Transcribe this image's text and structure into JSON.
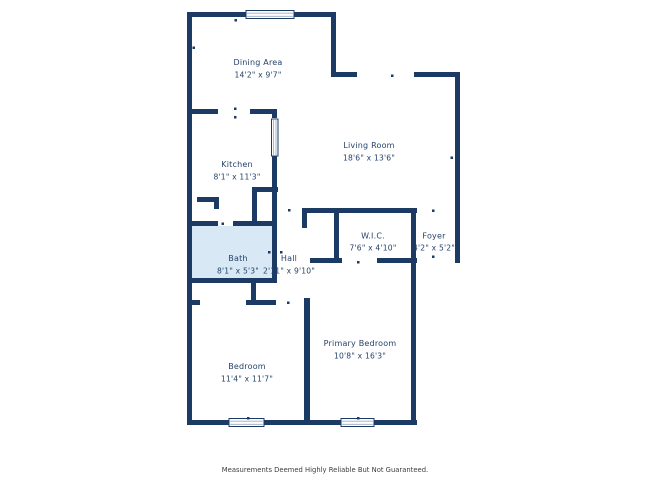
{
  "colors": {
    "wall": "#1b3a64",
    "room_label": "#24426b",
    "bath_fill": "#d9e8f5",
    "window_fill": "#ffffff",
    "window_mullion": "#9aabc2",
    "disclaimer_text": "#3d3d3d",
    "background": "#ffffff"
  },
  "rooms": [
    {
      "id": "dining-area",
      "name": "Dining Area",
      "dims": "14'2\" x 9'7\""
    },
    {
      "id": "living-room",
      "name": "Living Room",
      "dims": "18'6\" x 13'6\""
    },
    {
      "id": "kitchen",
      "name": "Kitchen",
      "dims": "8'1\" x 11'3\""
    },
    {
      "id": "bath",
      "name": "Bath",
      "dims": "8'1\" x 5'3\""
    },
    {
      "id": "hall",
      "name": "Hall",
      "dims": "2'11\" x 9'10\""
    },
    {
      "id": "wic",
      "name": "W.I.C.",
      "dims": "7'6\" x 4'10\""
    },
    {
      "id": "foyer",
      "name": "Foyer",
      "dims": "4'2\" x 5'2\""
    },
    {
      "id": "bedroom",
      "name": "Bedroom",
      "dims": "11'4\" x 11'7\""
    },
    {
      "id": "primary-bedroom",
      "name": "Primary Bedroom",
      "dims": "10'8\" x 16'3\""
    }
  ],
  "footer": {
    "disclaimer": "Measurements Deemed Highly Reliable But Not Guaranteed."
  }
}
